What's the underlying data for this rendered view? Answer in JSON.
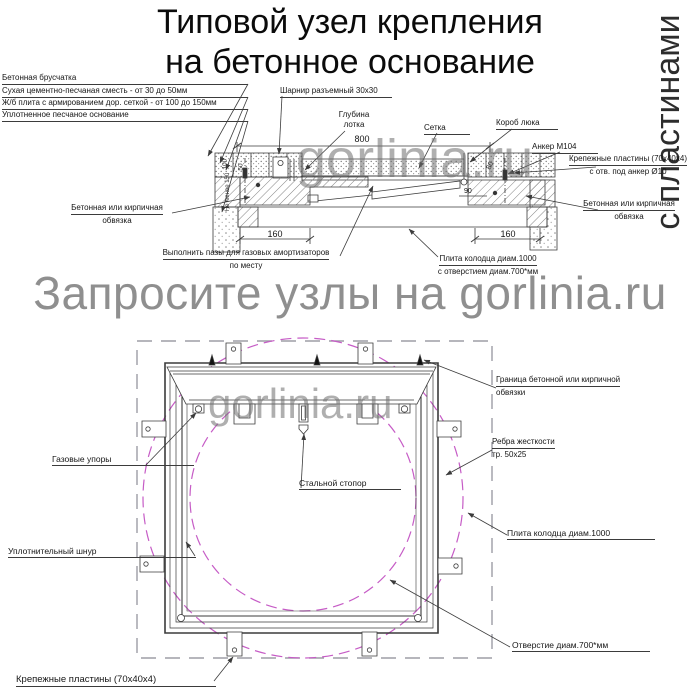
{
  "title": {
    "line1": "Типовой узел крепления",
    "line2": "на бетонное основание"
  },
  "watermarks": {
    "vertical": "с пластинами",
    "banner": "Запросите узлы на gorlinia.ru",
    "overlay_section": "gorlinia.ru",
    "overlay_plan": "gorlinia.ru"
  },
  "section": {
    "paving": "Бетонная брусчатка",
    "mix": "Сухая цементно-песчаная сместь - от 30 до 50мм",
    "slab_layer": "Ж/б плита с армированием дор. сеткой - от 100 до 150мм",
    "sand": "Уплотненное песчаное основание",
    "hinge": "Шарнир разъемный 30х30",
    "depth1": "Глубина",
    "depth2": "лотка",
    "mesh": "Сетка",
    "box": "Короб люка",
    "anchor": "Анкер М104",
    "plates1": "Крепежные пластины (70х40х4)",
    "plates2": "с отв. под анкер Ø10",
    "edging_r1": "Бетонная или кирпичная",
    "edging_r2": "обвязка",
    "edging_l1": "Бетонная или кирпичная",
    "edging_l2": "обвязка",
    "grooves1": "Выполнить пазы для газовых амортизаторов",
    "grooves2": "по месту",
    "well1": "Плита колодца диам.1000",
    "well2": "с отверстием диам.700*мм",
    "dim_width": "800",
    "dim_left": "160",
    "dim_right": "160",
    "dim_90": "90",
    "dim_80": "80",
    "dim_100": "100",
    "dim_50": "50",
    "dim_min": "Не менее 150"
  },
  "plan": {
    "boundary1": "Граница бетонной или кирпичной",
    "boundary2": "обвязки",
    "ribs1": "Ребра жесткости",
    "ribs2": "тр. 50х25",
    "slab": "Плита колодца диам.1000",
    "hole": "Отверстие диам.700*мм",
    "gas": "Газовые упоры",
    "stopper": "Стальной стопор",
    "cord": "Уплотнительный шнур",
    "plates": "Крепежные пластины (70х40х4)"
  }
}
